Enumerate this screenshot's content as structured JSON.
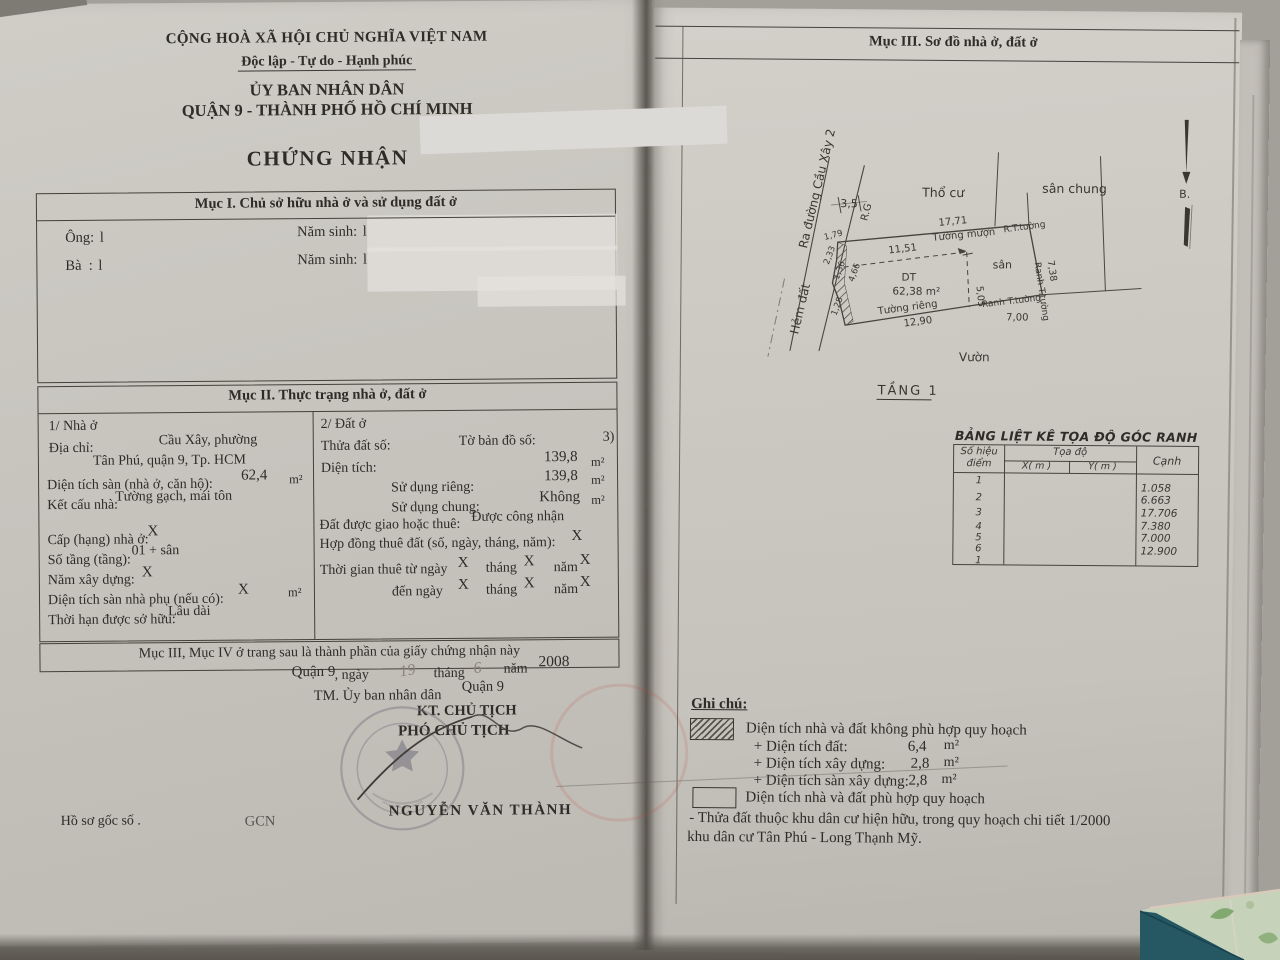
{
  "colors": {
    "paper": "#cdc9c3",
    "ink": "#2f2c28",
    "stamp": "#7b7b84",
    "handwriting": "#8a837a",
    "tile_green": "#c7d2ba",
    "tile_teal": "#235763"
  },
  "left": {
    "header": {
      "country": "CỘNG HOÀ XÃ HỘI CHỦ NGHĨA VIỆT NAM",
      "motto": "Độc lập - Tự do - Hạnh phúc",
      "issuer_line1": "ỦY BAN NHÂN DÂN",
      "issuer_line2": "QUẬN 9 - THÀNH PHỐ HỒ CHÍ MINH",
      "doc_title": "CHỨNG NHẬN"
    },
    "muc1": {
      "title": "Mục I. Chủ sở hữu nhà ở và sử dụng đất ở",
      "ong_label": "Ông:",
      "ong_value": "l",
      "birth1_label": "Năm sinh:",
      "birth1_value": "l",
      "ba_label": "Bà  :",
      "ba_value": "l",
      "birth2_label": "Năm sinh:",
      "birth2_value": "l"
    },
    "muc2": {
      "title": "Mục II. Thực trạng nhà ở, đất ở",
      "house": {
        "heading": "1/ Nhà ở",
        "addr_label": "Địa chỉ:",
        "addr_value1": "Cầu Xây, phường",
        "addr_value2": "Tân Phú, quận 9, Tp. HCM",
        "floor_area_label": "Diện tích sàn (nhà ở, căn hộ):",
        "floor_area_value": "62,4",
        "floor_area_unit": "m²",
        "structure_label": "Kết cấu nhà:",
        "structure_value": "Tường gạch, mái tôn",
        "grade_label": "Cấp (hạng) nhà ở:",
        "grade_value": "X",
        "floors_label": "Số tầng (tầng):",
        "floors_value": "01 + sân",
        "year_label": "Năm xây dựng:",
        "year_value": "X",
        "aux_label": "Diện tích sàn nhà phụ (nếu có):",
        "aux_value": "X",
        "aux_unit": "m²",
        "tenure_label": "Thời hạn được sở hữu:",
        "tenure_value": "Lâu dài"
      },
      "land": {
        "heading": "2/ Đất ở",
        "plot_label": "Thửa đất số:",
        "map_label": "Tờ bản đồ số:",
        "map_value": "3)",
        "area_label": "Diện tích:",
        "area_value": "139,8",
        "area_unit": "m²",
        "private_label": "Sử dụng riêng:",
        "private_value": "139,8",
        "private_unit": "m²",
        "shared_label": "Sử dụng chung:",
        "shared_value": "Không",
        "shared_unit": "m²",
        "granted_label": "Đất được giao hoặc thuê:",
        "granted_value": "Được công nhận",
        "contract_label": "Hợp đồng thuê đất (số, ngày, tháng, năm):",
        "contract_value": "X",
        "lease_from_label": "Thời gian thuê từ ngày",
        "lease_to_label": "đến ngày",
        "month_label": "tháng",
        "year_label": "năm",
        "x_mark": "X"
      }
    },
    "footer_note": "Mục III, Mục IV ở trang sau là thành phần của giấy chứng nhận này",
    "signing": {
      "place": "Quận 9",
      "day_prefix": ", ngày",
      "day_value": "19",
      "month_label": "tháng",
      "month_value": "6",
      "year_label": "năm",
      "year_value": "2008",
      "tm_line": "TM. Ủy ban nhân dân",
      "tm_place": "Quận 9",
      "kt_line": "KT. CHỦ TỊCH",
      "deputy_line": "PHÓ CHỦ TỊCH",
      "signer_name": "NGUYỄN VĂN THÀNH"
    },
    "bottom": {
      "dossier_label": "Hồ sơ gốc số .",
      "gcn_label": "GCN"
    }
  },
  "right": {
    "title": "Mục III. Sơ đồ nhà ở, đất ở",
    "plan": {
      "road_label": "Ra đường Cầu Xây 2",
      "alley_label": "Hẻm đất",
      "rg_label": "R.G",
      "road_width": "3,5",
      "residential_label": "Thổ cư",
      "shared_yard_label": "sân chung",
      "top_dim": "17,71",
      "top_edge_label": "Tường mượn",
      "rt_wall_label": "R.T.tường",
      "right_edge_label": "Ranh T.tường",
      "right_dim": "7,38",
      "yard_label": "sân",
      "area_label": "DT",
      "area_value": "62,38 m²",
      "inner_width": "11,51",
      "inner_height": "5,05",
      "bottom_right_label": "Ranh T.tường",
      "bottom_right_dim": "7,00",
      "bottom_left_label": "Tường riêng",
      "bottom_left_dim": "12,90",
      "left_dims": [
        "1,79",
        "2,33",
        "1,36",
        "4,66",
        "1,28"
      ],
      "garden_label": "Vườn",
      "floor_label": "TẦNG 1",
      "north_label": "B."
    },
    "coord_table": {
      "title": "BẢNG LIỆT KÊ TỌA ĐỘ GÓC RANH",
      "point_header_line1": "Số hiệu",
      "point_header_line2": "điểm",
      "coord_header": "Tọa độ",
      "x_header": "X( m )",
      "y_header": "Y( m )",
      "edge_header": "Cạnh",
      "points": [
        "1",
        "2",
        "3",
        "4",
        "5",
        "6",
        "1"
      ],
      "edges": [
        "1.058",
        "6.663",
        "17.706",
        "7.380",
        "7.000",
        "12.900"
      ]
    },
    "notes": {
      "title": "Ghi chú:",
      "nonconform_label": "Diện tích nhà và đất không phù hợp quy hoạch",
      "area_items": [
        {
          "label": "+ Diện tích đất:",
          "value": "6,4",
          "unit": "m²"
        },
        {
          "label": "+ Diện tích xây dựng:",
          "value": "2,8",
          "unit": "m²"
        },
        {
          "label": "+ Diện tích sàn xây dựng:",
          "value": "2,8",
          "unit": "m²"
        }
      ],
      "conform_label": "Diện tích nhà và đất phù hợp quy hoạch",
      "remark_line1": "- Thửa đất thuộc khu dân cư hiện hữu, trong quy hoạch chi tiết 1/2000",
      "remark_line2": "khu dân cư Tân Phú - Long Thạnh Mỹ."
    }
  }
}
